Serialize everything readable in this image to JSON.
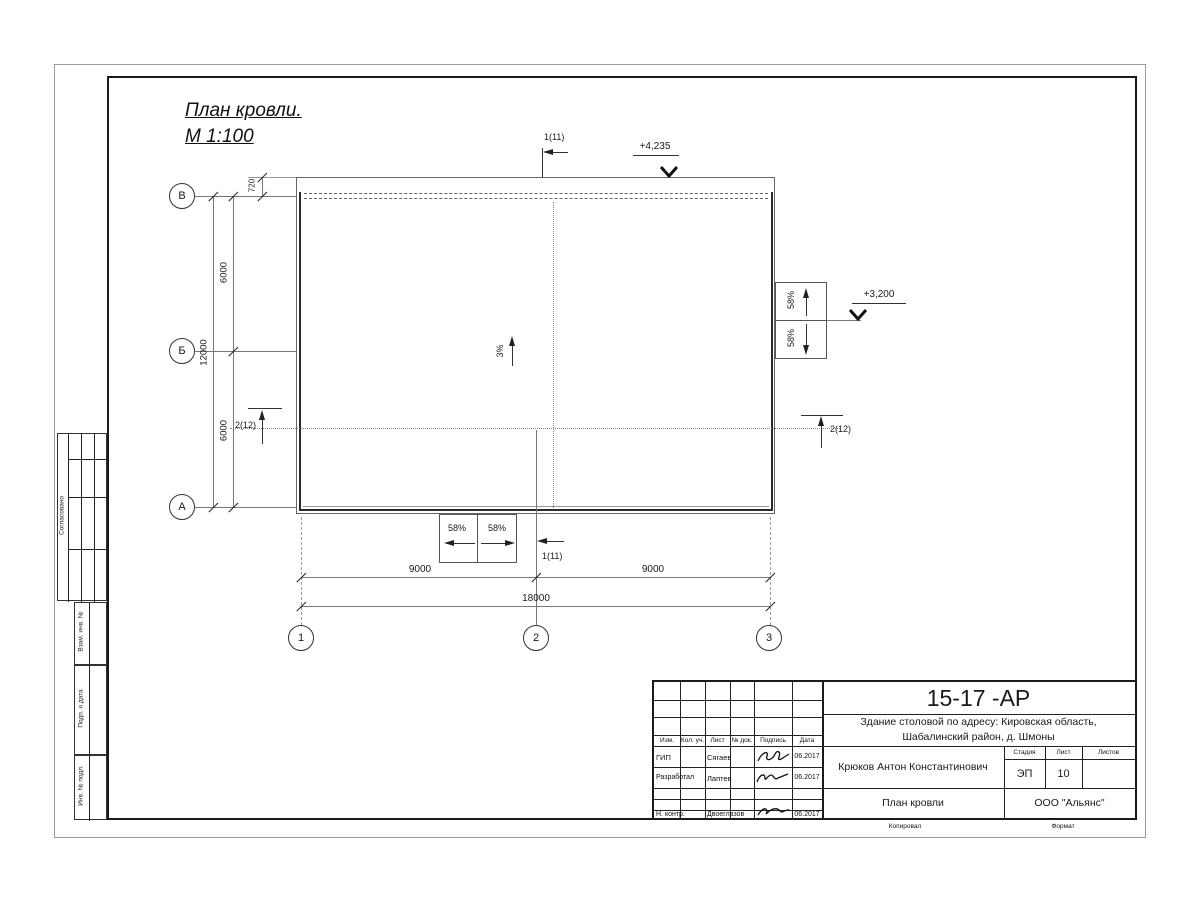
{
  "sheet": {
    "title_line1": "План кровли.",
    "title_line2": "М 1:100"
  },
  "axes": {
    "v1": "В",
    "v2": "Б",
    "v3": "А",
    "h1": "1",
    "h2": "2",
    "h3": "3"
  },
  "dims": {
    "d720": "720",
    "d6000a": "6000",
    "d6000b": "6000",
    "d12000": "12000",
    "d9000a": "9000",
    "d9000b": "9000",
    "d18000": "18000"
  },
  "marks": {
    "elev_top": "+4,235",
    "elev_right": "+3,200",
    "slope": "3%",
    "canopy_slope": "58%",
    "section_v": "1(11)",
    "section_h": "2(12)"
  },
  "margin": {
    "approved": "Согласовано",
    "vzam": "Взам. инв. №",
    "podp": "Подп. и дата",
    "inv": "Инв. № подл."
  },
  "title_block": {
    "doc_number": "15-17 -АР",
    "object_line1": "Здание столовой по адресу: Кировская область,",
    "object_line2": "Шабалинский район, д. Шмоны",
    "header_cols": [
      "Изм.",
      "Кол. уч.",
      "Лист",
      "№ док.",
      "Подпись",
      "Дата"
    ],
    "rows": [
      {
        "role": "ГИП",
        "name": "Сягаев",
        "date": "06.2017"
      },
      {
        "role": "Разработал",
        "name": "Лаптев",
        "date": "06.2017"
      },
      {
        "role": "Н. контр.",
        "name": "Двоеглазов",
        "date": "06.2017"
      }
    ],
    "author": "Крюков Антон Константинович",
    "stage_label": "Стадия",
    "sheet_label": "Лист",
    "sheets_label": "Листов",
    "stage": "ЭП",
    "sheet_no": "10",
    "drawing_name": "План кровли",
    "company": "ООО \"Альянс\"",
    "copied": "Копировал",
    "format": "Формат"
  }
}
